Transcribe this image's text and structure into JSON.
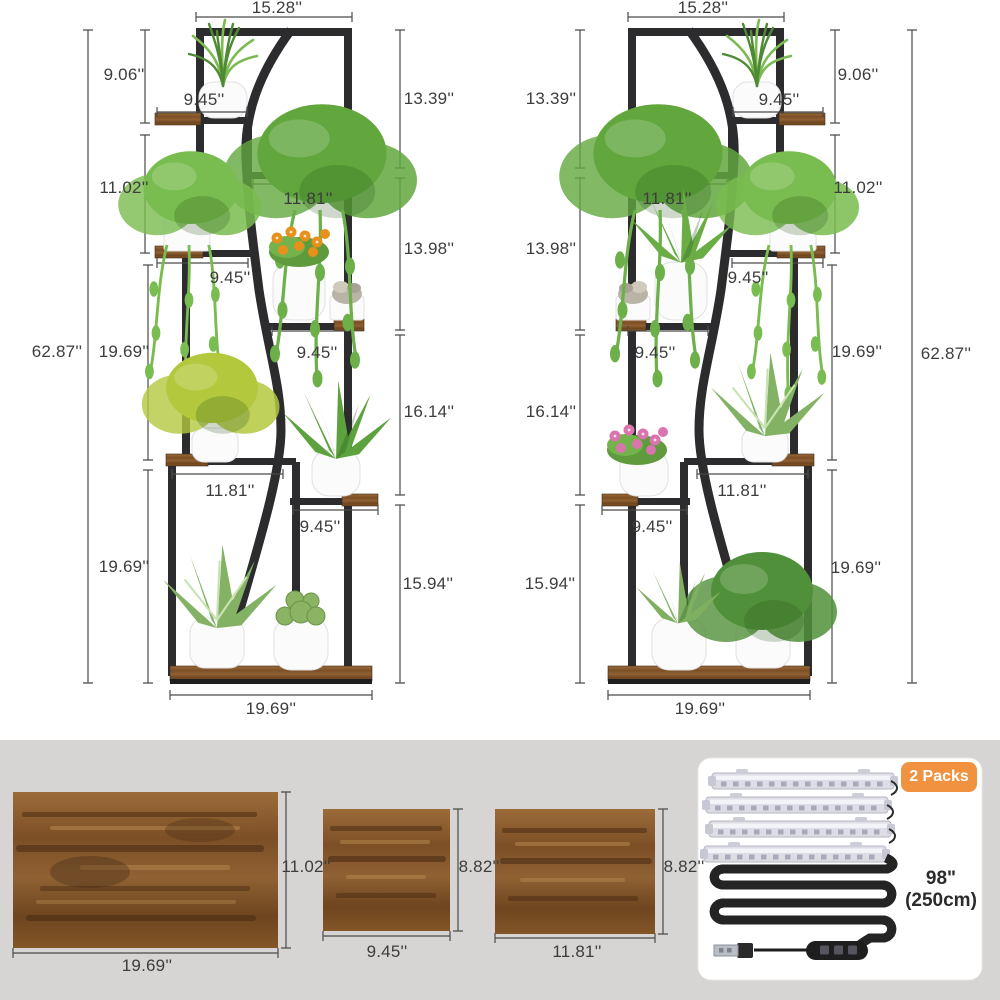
{
  "left_stand": {
    "dim_labels": {
      "top_width": "15.28''",
      "top_tier_height": "9.06''",
      "tier2_shelf_width": "9.45''",
      "upper_tier_height": "13.39''",
      "middle_tier_height": "11.02''",
      "tier3_shelf_width": "11.81''",
      "lower_middle_tier_height": "13.98''",
      "tier4_shelf_width": "9.45''",
      "overall_height": "62.87''",
      "center_tier_height": "19.69''",
      "tier5_shelf_width": "9.45''",
      "lower_tier_height": "16.14''",
      "tier5b_shelf_width": "11.81''",
      "tier6_shelf_width": "9.45''",
      "bottom_tier_height": "19.69''",
      "bottom_outer_tier_height": "15.94''",
      "base_width": "19.69''"
    }
  },
  "right_stand": {
    "dim_labels": {
      "top_width": "15.28''",
      "top_tier_height": "9.06''",
      "tier2_shelf_width": "9.45''",
      "upper_tier_height": "13.39''",
      "middle_tier_height": "11.02''",
      "tier3_shelf_width": "11.81''",
      "lower_middle_tier_height": "13.98''",
      "tier4_shelf_width": "9.45''",
      "overall_height": "62.87''",
      "center_tier_height": "19.69''",
      "tier5_shelf_width": "9.45''",
      "lower_tier_height": "16.14''",
      "tier5b_shelf_width": "11.81''",
      "tier6_shelf_width": "9.45''",
      "bottom_tier_height": "19.69''",
      "bottom_outer_tier_height": "15.94''",
      "base_width": "19.69''"
    }
  },
  "shelf_panels": {
    "large": {
      "width": "19.69''",
      "height": "11.02''"
    },
    "small": {
      "width": "9.45''",
      "height": "8.82''"
    },
    "medium": {
      "width": "11.81''",
      "height": "8.82''"
    }
  },
  "grow_light_kit": {
    "badge": "2 Packs",
    "strip_count": 4,
    "cable_length_in": "98\"",
    "cable_length_cm": "(250cm)"
  },
  "colors": {
    "background": "#ffffff",
    "panel_section_background": "#d6d5d3",
    "badge_orange": "#f0923f",
    "frame_black": "#2c2c2e",
    "wood_brown": "#855327",
    "dimension_text": "#3d3d3d"
  }
}
